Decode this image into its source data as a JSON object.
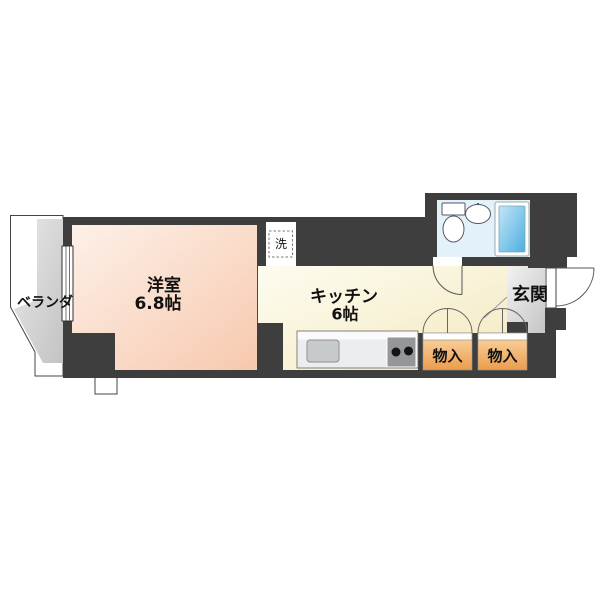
{
  "floorplan": {
    "veranda": {
      "label": "ベランダ"
    },
    "western_room": {
      "label": "洋室",
      "size": "6.8帖"
    },
    "kitchen": {
      "label": "キッチン",
      "size": "6帖"
    },
    "entrance": {
      "label": "玄関"
    },
    "closet_left": {
      "label": "物入"
    },
    "closet_right": {
      "label": "物入"
    },
    "washer": {
      "label": "洗"
    },
    "colors": {
      "wall": "#3e3e3e",
      "western_room_fill": "#f9d0ba",
      "kitchen_fill": "#f6edc8",
      "veranda_fill": "#d2d2d2",
      "entrance_fill": "#d8d8d8",
      "closet_fill": "#ee9e4e",
      "bathroom_floor": "#e3f2fa",
      "bathtub_fill": "#55b0e0",
      "counter_fill": "#ecedf1"
    }
  }
}
